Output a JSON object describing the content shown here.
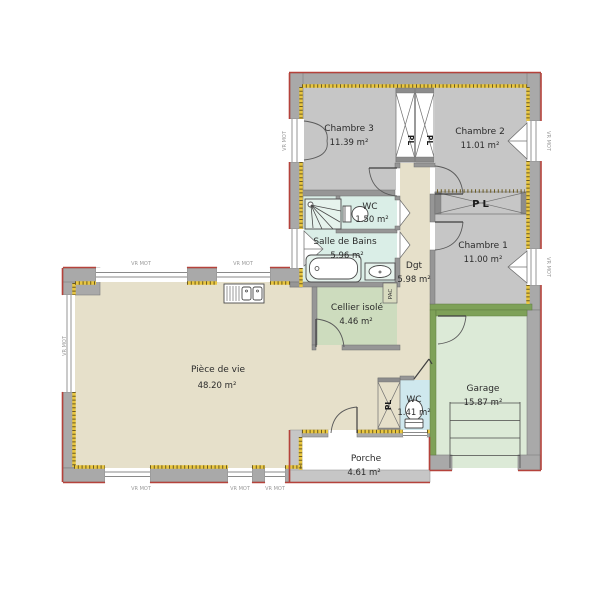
{
  "rooms": [
    {
      "name": "Chambre 3",
      "area": "11.39 m²"
    },
    {
      "name": "Chambre 2",
      "area": "11.01 m²"
    },
    {
      "name": "Chambre 1",
      "area": "11.00 m²"
    },
    {
      "name": "WC",
      "area": "1.50 m²"
    },
    {
      "name": "Salle de Bains",
      "area": "5.96 m²"
    },
    {
      "name": "Dgt",
      "area": "5.98 m²"
    },
    {
      "name": "Cellier isolé",
      "area": "4.46 m²"
    },
    {
      "name": "Pièce de vie",
      "area": "48.20 m²"
    },
    {
      "name": "WC",
      "area": "1.41 m²"
    },
    {
      "name": "Garage",
      "area": "15.87 m²"
    },
    {
      "name": "Porche",
      "area": "4.61 m²"
    }
  ],
  "labels": {
    "closet": "PL",
    "heat_pump": "PAC",
    "roller_shutter": "VR MOT"
  },
  "colors": {
    "outline_red": "#b5423b",
    "insulation_yellow": "#e9c63f",
    "exterior_wall": "#a9a9a9",
    "green_partition": "#7ea158",
    "bedroom_floor": "#c6c6c6",
    "bathroom_floor": "#daeee7",
    "living_floor": "#e6e0ca",
    "cellar_floor": "#cddcbe",
    "garage_floor": "#dcead7",
    "wc_floor": "#cfe8ee"
  }
}
